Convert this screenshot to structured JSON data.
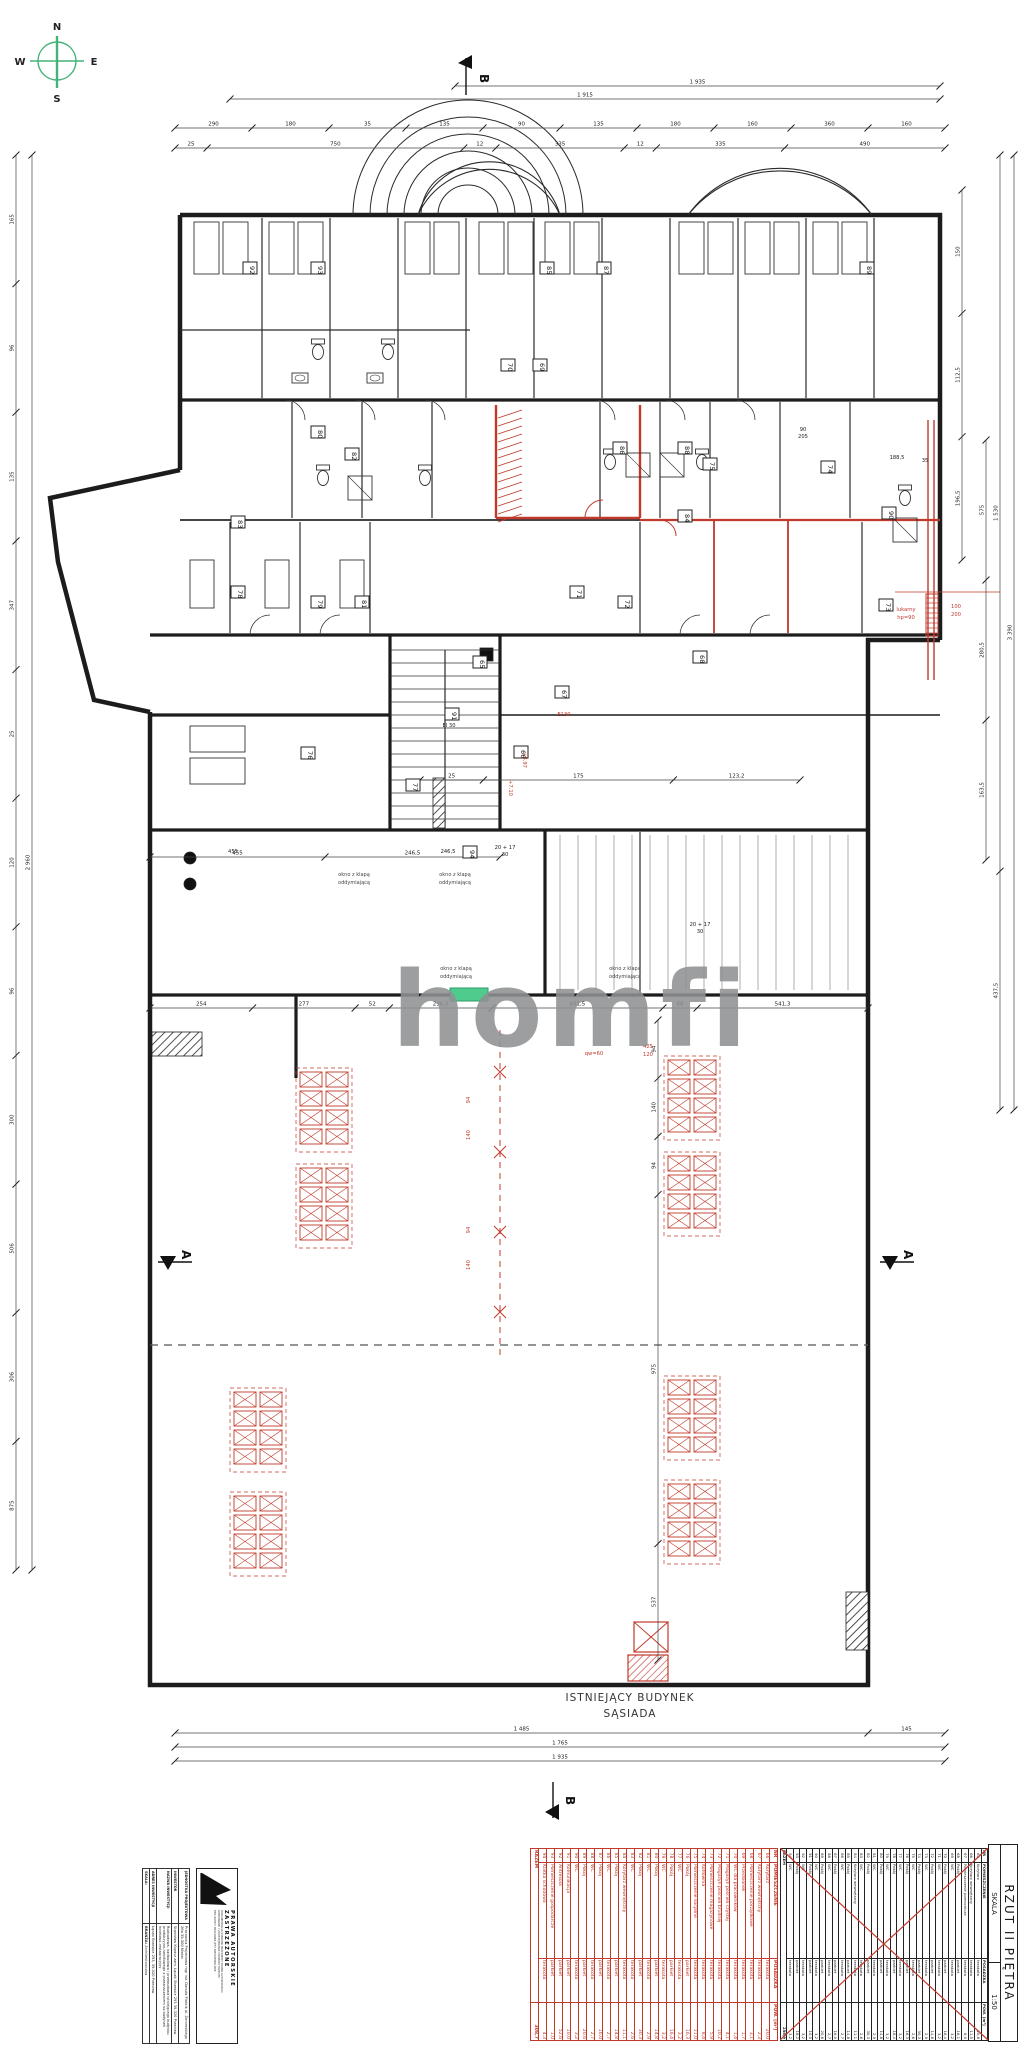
{
  "compass": {
    "n": "N",
    "e": "E",
    "s": "S",
    "w": "W"
  },
  "logo": {
    "text": "homfi"
  },
  "colors": {
    "accent_green": "#44b37a",
    "highlight_green": "#4ecb8d",
    "annotation_red": "#c0392b",
    "ink": "#1a1a1a",
    "logo_grey": "#8f9193"
  },
  "plan": {
    "section_a": "A",
    "section_b": "B",
    "neighbor_line1": "ISTNIEJĄCY BUDYNEK",
    "neighbor_line2": "SĄSIADA",
    "window_note_line1": "okno z klapą",
    "window_note_line2": "oddymiającą",
    "room_numbers": [
      "65",
      "66",
      "67",
      "68",
      "69",
      "70",
      "71",
      "72",
      "73",
      "74",
      "75",
      "76",
      "77",
      "78",
      "79",
      "80",
      "81",
      "82",
      "83",
      "84",
      "85",
      "86",
      "87",
      "88",
      "89",
      "90",
      "91",
      "92",
      "93",
      "94"
    ],
    "red_texts": [
      "+7.10",
      "+8.97",
      "E130",
      "100",
      "200",
      "lukarny",
      "hp=90",
      "425",
      "120",
      "qw=60",
      "94",
      "140",
      "94",
      "140"
    ],
    "black_texts": [
      "188,5",
      "35",
      "455",
      "246,5",
      "20 + 17",
      "30",
      "20 + 17",
      "30",
      "EI 30",
      "90",
      "205"
    ]
  },
  "dims": {
    "top_total_1": [
      "1 935"
    ],
    "top_total_2": [
      "1 915"
    ],
    "top_row": [
      "290",
      "180",
      "35",
      "135",
      "90",
      "135",
      "180",
      "160",
      "360",
      "160"
    ],
    "top_row2": [
      "25",
      "750",
      "12",
      "335",
      "12",
      "335",
      "490"
    ],
    "left_col": [
      "165",
      "96",
      "135",
      "347",
      "25",
      "120",
      "96",
      "300",
      "506",
      "306",
      "875"
    ],
    "left_col2": [
      "2 960"
    ],
    "right_inner": [
      "150",
      "112,5",
      "196,5"
    ],
    "right_col": [
      "575",
      "280,5",
      "163,5"
    ],
    "right_col2": [
      "1 530",
      "437,5"
    ],
    "right_col3": [
      "3 390"
    ],
    "mid_row": [
      "254",
      "277",
      "52",
      "296,5",
      "491,5",
      "68",
      "541,3"
    ],
    "mid_row2": [
      "455",
      "246,5"
    ],
    "mid_row3": [
      "25",
      "175",
      "123,2"
    ],
    "inner_col": [
      "94",
      "140",
      "94",
      "975",
      "537"
    ],
    "bottom_row1": [
      "1 485",
      "145"
    ],
    "bottom_row2": [
      "1 765"
    ],
    "bottom_row3": [
      "1 935"
    ]
  },
  "schedule_new": {
    "headers": [
      "NR",
      "POMIESZCZENIE",
      "POSADZKA",
      "POW. [m²]"
    ],
    "rows": [
      [
        "66",
        "Korytarz",
        "terakota",
        "20,0"
      ],
      [
        "67",
        "Korytarz wewnętrzny",
        "terakota",
        "2,3"
      ],
      [
        "68",
        "Pomieszczenie porządkowe",
        "terakota",
        "3,1"
      ],
      [
        "69",
        "Przedsionek",
        "terakota",
        "1,7"
      ],
      [
        "70",
        "WC dla pracowników",
        "terakota",
        "1,4"
      ],
      [
        "71",
        "Magazyn pościeli czystej",
        "terakota",
        "4,1"
      ],
      [
        "72",
        "Magazyn pościeli brudnej",
        "terakota",
        "10,2"
      ],
      [
        "73",
        "Pomieszczenie magazynowe",
        "terakota",
        "5,9"
      ],
      [
        "74",
        "Kotłownia",
        "terakota",
        "8,4"
      ],
      [
        "75",
        "Pomieszczenie socjalne",
        "terakota",
        "11,0"
      ],
      [
        "76",
        "Pokój",
        "parkiet",
        "16,3"
      ],
      [
        "77",
        "WC",
        "terakota",
        "3,2"
      ],
      [
        "78",
        "Pokój",
        "parkiet",
        "16,4"
      ],
      [
        "79",
        "WC",
        "terakota",
        "3,2"
      ],
      [
        "80",
        "Pokój",
        "parkiet",
        "14,8"
      ],
      [
        "81",
        "WC",
        "terakota",
        "2,9"
      ],
      [
        "82",
        "Pokój",
        "parkiet",
        "30,3"
      ],
      [
        "83",
        "WC",
        "terakota",
        "2,6"
      ],
      [
        "84",
        "Korytarz wewnętrzny",
        "terakota",
        "11,1"
      ],
      [
        "85",
        "Pokój",
        "parkiet",
        "14,8"
      ],
      [
        "86",
        "WC",
        "terakota",
        "2,7"
      ],
      [
        "87",
        "Pokój",
        "parkiet",
        "16,0"
      ],
      [
        "88",
        "WC",
        "terakota",
        "2,7"
      ],
      [
        "89",
        "Pokój",
        "parkiet",
        "20,6"
      ],
      [
        "90",
        "WC",
        "terakota",
        "3,2"
      ],
      [
        "91",
        "Komunikacja",
        "parkiet",
        "10,0"
      ],
      [
        "92",
        "Antresola",
        "parkiet",
        "52,6"
      ],
      [
        "93",
        "Pomieszczenie gospodarcze",
        "parkiet",
        "1,0"
      ],
      [
        "94",
        "Klatka schodowa",
        "terakota",
        "4,3"
      ]
    ],
    "total_label": "RAZEM",
    "total_value": "308,7"
  },
  "schedule_old": {
    "headers": [
      "NR",
      "POMIESZCZENIE",
      "POSADZKA",
      "POW. [m²]"
    ],
    "rows": [
      [
        "65",
        "Korytarz",
        "terakota",
        "20,8"
      ],
      [
        "66",
        "Korytarz wewnętrzny",
        "terakota",
        "11,5"
      ],
      [
        "67",
        "Pomieszczenie pomocnicze",
        "terakota",
        "6,0"
      ],
      [
        "68",
        "Pokój",
        "parkiet",
        "16,1"
      ],
      [
        "69",
        "WC",
        "terakota",
        "3,2"
      ],
      [
        "70",
        "Pokój",
        "parkiet",
        "16,4"
      ],
      [
        "71",
        "WC",
        "terakota",
        "3,2"
      ],
      [
        "72",
        "Pokój",
        "parkiet",
        "14,8"
      ],
      [
        "73",
        "WC",
        "terakota",
        "2,9"
      ],
      [
        "74",
        "Pokój",
        "parkiet",
        "30,3"
      ],
      [
        "75",
        "WC",
        "terakota",
        "2,6"
      ],
      [
        "76",
        "Pokój",
        "parkiet",
        "16,3"
      ],
      [
        "77",
        "WC",
        "terakota",
        "3,2"
      ],
      [
        "78",
        "Pokój",
        "parkiet",
        "16,4"
      ],
      [
        "79",
        "WC",
        "terakota",
        "3,2"
      ],
      [
        "80",
        "Pokój",
        "parkiet",
        "14,8"
      ],
      [
        "81",
        "WC",
        "terakota",
        "2,9"
      ],
      [
        "82",
        "Pokój",
        "parkiet",
        "30,3"
      ],
      [
        "83",
        "WC",
        "terakota",
        "2,6"
      ],
      [
        "84",
        "Korytarz wewnętrzny",
        "terakota",
        "11,1"
      ],
      [
        "85",
        "Pokój",
        "parkiet",
        "14,8"
      ],
      [
        "86",
        "WC",
        "terakota",
        "2,7"
      ],
      [
        "87",
        "Pokój",
        "parkiet",
        "16,0"
      ],
      [
        "88",
        "WC",
        "terakota",
        "2,7"
      ],
      [
        "89",
        "Pokój",
        "parkiet",
        "20,6"
      ],
      [
        "90",
        "WC",
        "terakota",
        "3,2"
      ],
      [
        "91",
        "Pokój",
        "parkiet",
        "10,0"
      ],
      [
        "92",
        "WC",
        "terakota",
        "3,2"
      ],
      [
        "93",
        "Pokój",
        "parkiet",
        "18,2"
      ],
      [
        "94",
        "WC",
        "terakota",
        "3,2"
      ]
    ],
    "total_label": "RAZEM",
    "total_value": "258,9"
  },
  "title_block": {
    "copyright_title": "PRAWA AUTORSKIE ZASTRZEŻONE",
    "copyright_lines": [
      "DOKUMENTACJA STANOWI PRZEDMIOT PRAWA AUTORSKIEGO",
      "KOPIOWANIE I UDOSTĘPNIANIE OSOBOM TRZECIM",
      "BEZ ZGODY PRACOWNI JEST NIEDOZWOLONE"
    ],
    "rows": [
      {
        "label": "JEDNOSTKA PROJEKTOWA",
        "value": "Pracownia Projektowa mgr inż. Danuta Piaścik ul. Żeromskiego 26a 39-300 Mielec"
      },
      {
        "label": "INWESTOR",
        "value": "Stanisław Kopacz zam. Łączki Brzeskie 293 39-320 Przecław"
      },
      {
        "label": "NAZWA INWESTYCJI",
        "value": "Rozbudowa, nadbudowa i przebudowa istniejącego budynku produkcyjno-handlowego z przeznaczeniem na budynek hotelowo-restauracyjny"
      },
      {
        "label": "ADRES INWESTYCJI",
        "value": "Łączki Brzeskie 293, 39-320 Przecław"
      }
    ],
    "branza_label": "BRANŻA:",
    "branza_value": "Architektoniczna",
    "scale_label": "SKALA:"
  },
  "drawing_info": {
    "title": "RZUT II PIĘTRA",
    "scale_label": "SKALA",
    "scale_value": "1:50"
  }
}
